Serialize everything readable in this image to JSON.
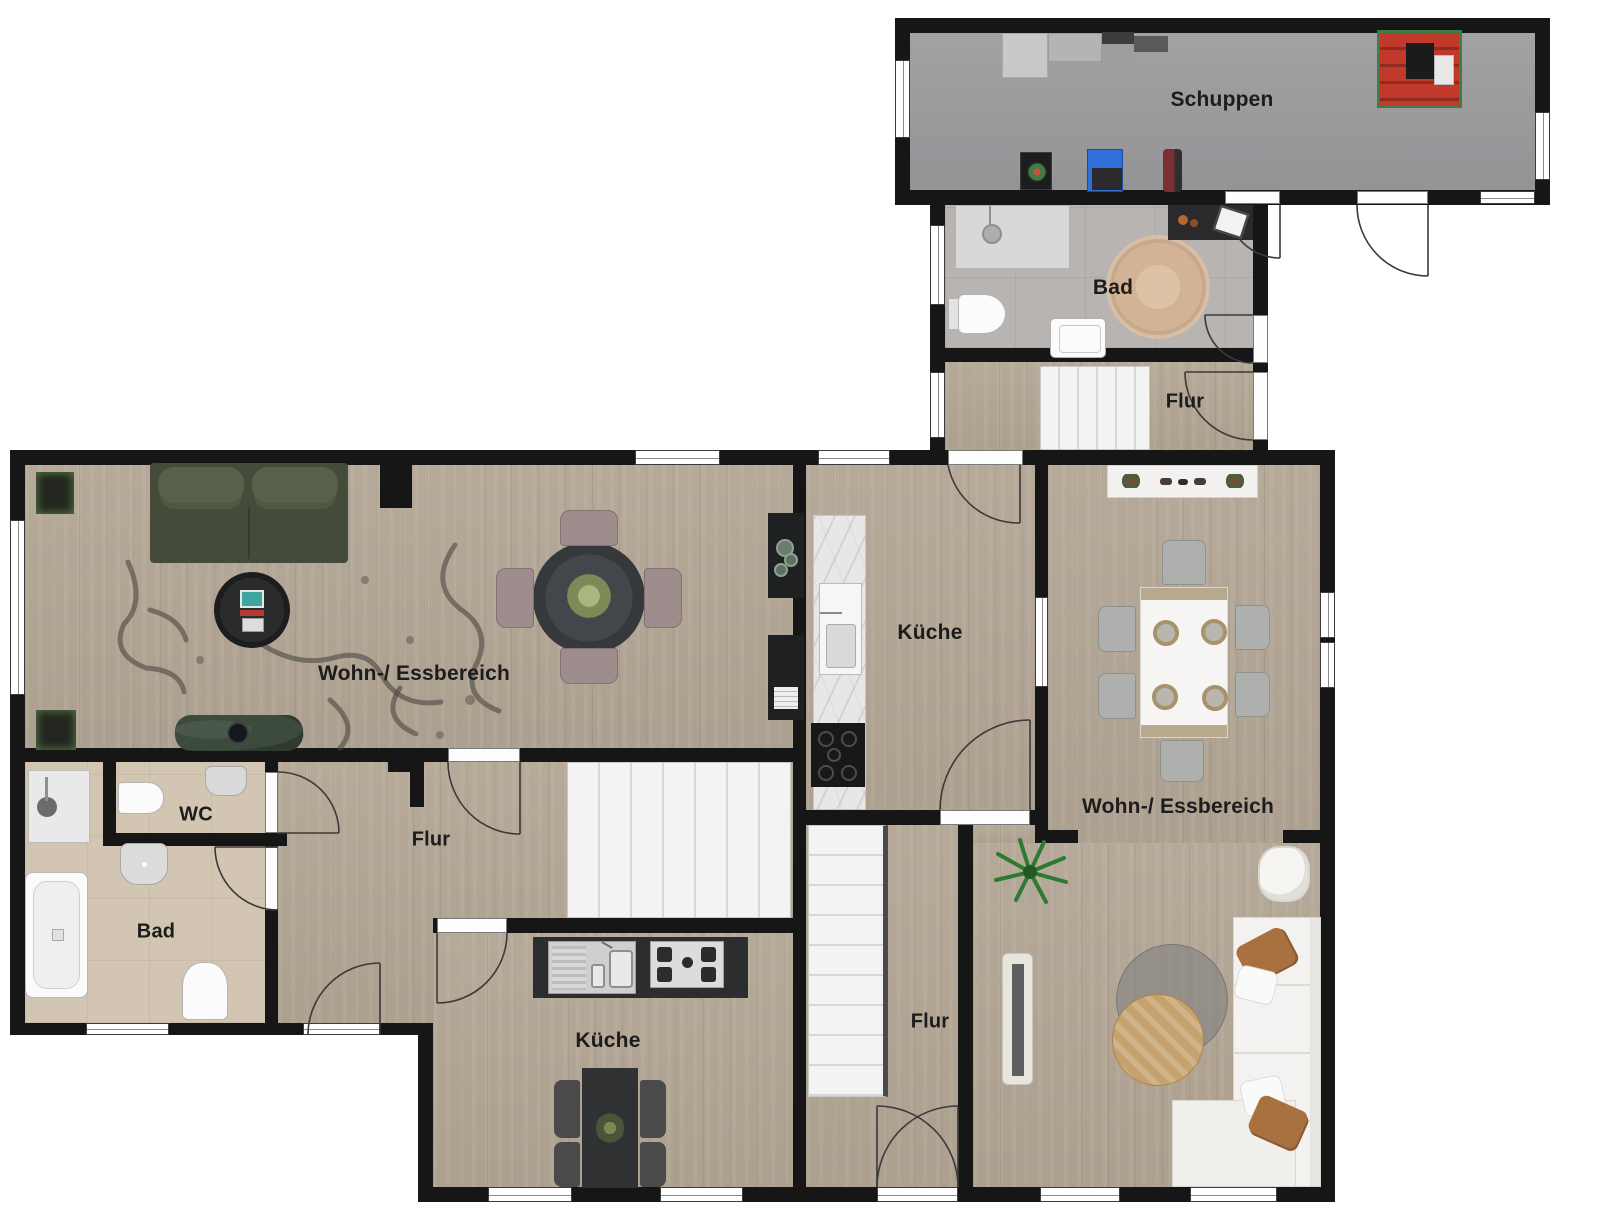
{
  "rooms": [
    {
      "id": "schuppen",
      "label": "Schuppen"
    },
    {
      "id": "bad-upper",
      "label": "Bad"
    },
    {
      "id": "flur-upper",
      "label": "Flur"
    },
    {
      "id": "wohn-essbereich-l",
      "label": "Wohn-/ Essbereich"
    },
    {
      "id": "kueche-middle",
      "label": "Küche"
    },
    {
      "id": "wc",
      "label": "WC"
    },
    {
      "id": "bad-lower",
      "label": "Bad"
    },
    {
      "id": "flur-left",
      "label": "Flur"
    },
    {
      "id": "kueche-lower",
      "label": "Küche"
    },
    {
      "id": "flur-lower",
      "label": "Flur"
    },
    {
      "id": "wohn-essbereich-r",
      "label": "Wohn-/ Essbereich"
    }
  ],
  "colors": {
    "wall": "#161616",
    "wood_floor": "#b3a695",
    "tile_beige": "#d2c5b2",
    "tile_gray": "#b7b4b1",
    "shed_floor": "#9d9da0",
    "sofa_green": "#454b3a",
    "chair_mauve": "#9d8d8c",
    "sofa_white": "#f3f2f0",
    "pillow_brown": "#a9713f",
    "shelf_red": "#c0392b",
    "cart_blue": "#2e6fd8",
    "marble_counter": "#e9e7e5",
    "dark_counter": "#2b2d2f",
    "rug_round_beige": "#d8bb9e",
    "sideboard_marble_green": "#3d4b3d"
  }
}
